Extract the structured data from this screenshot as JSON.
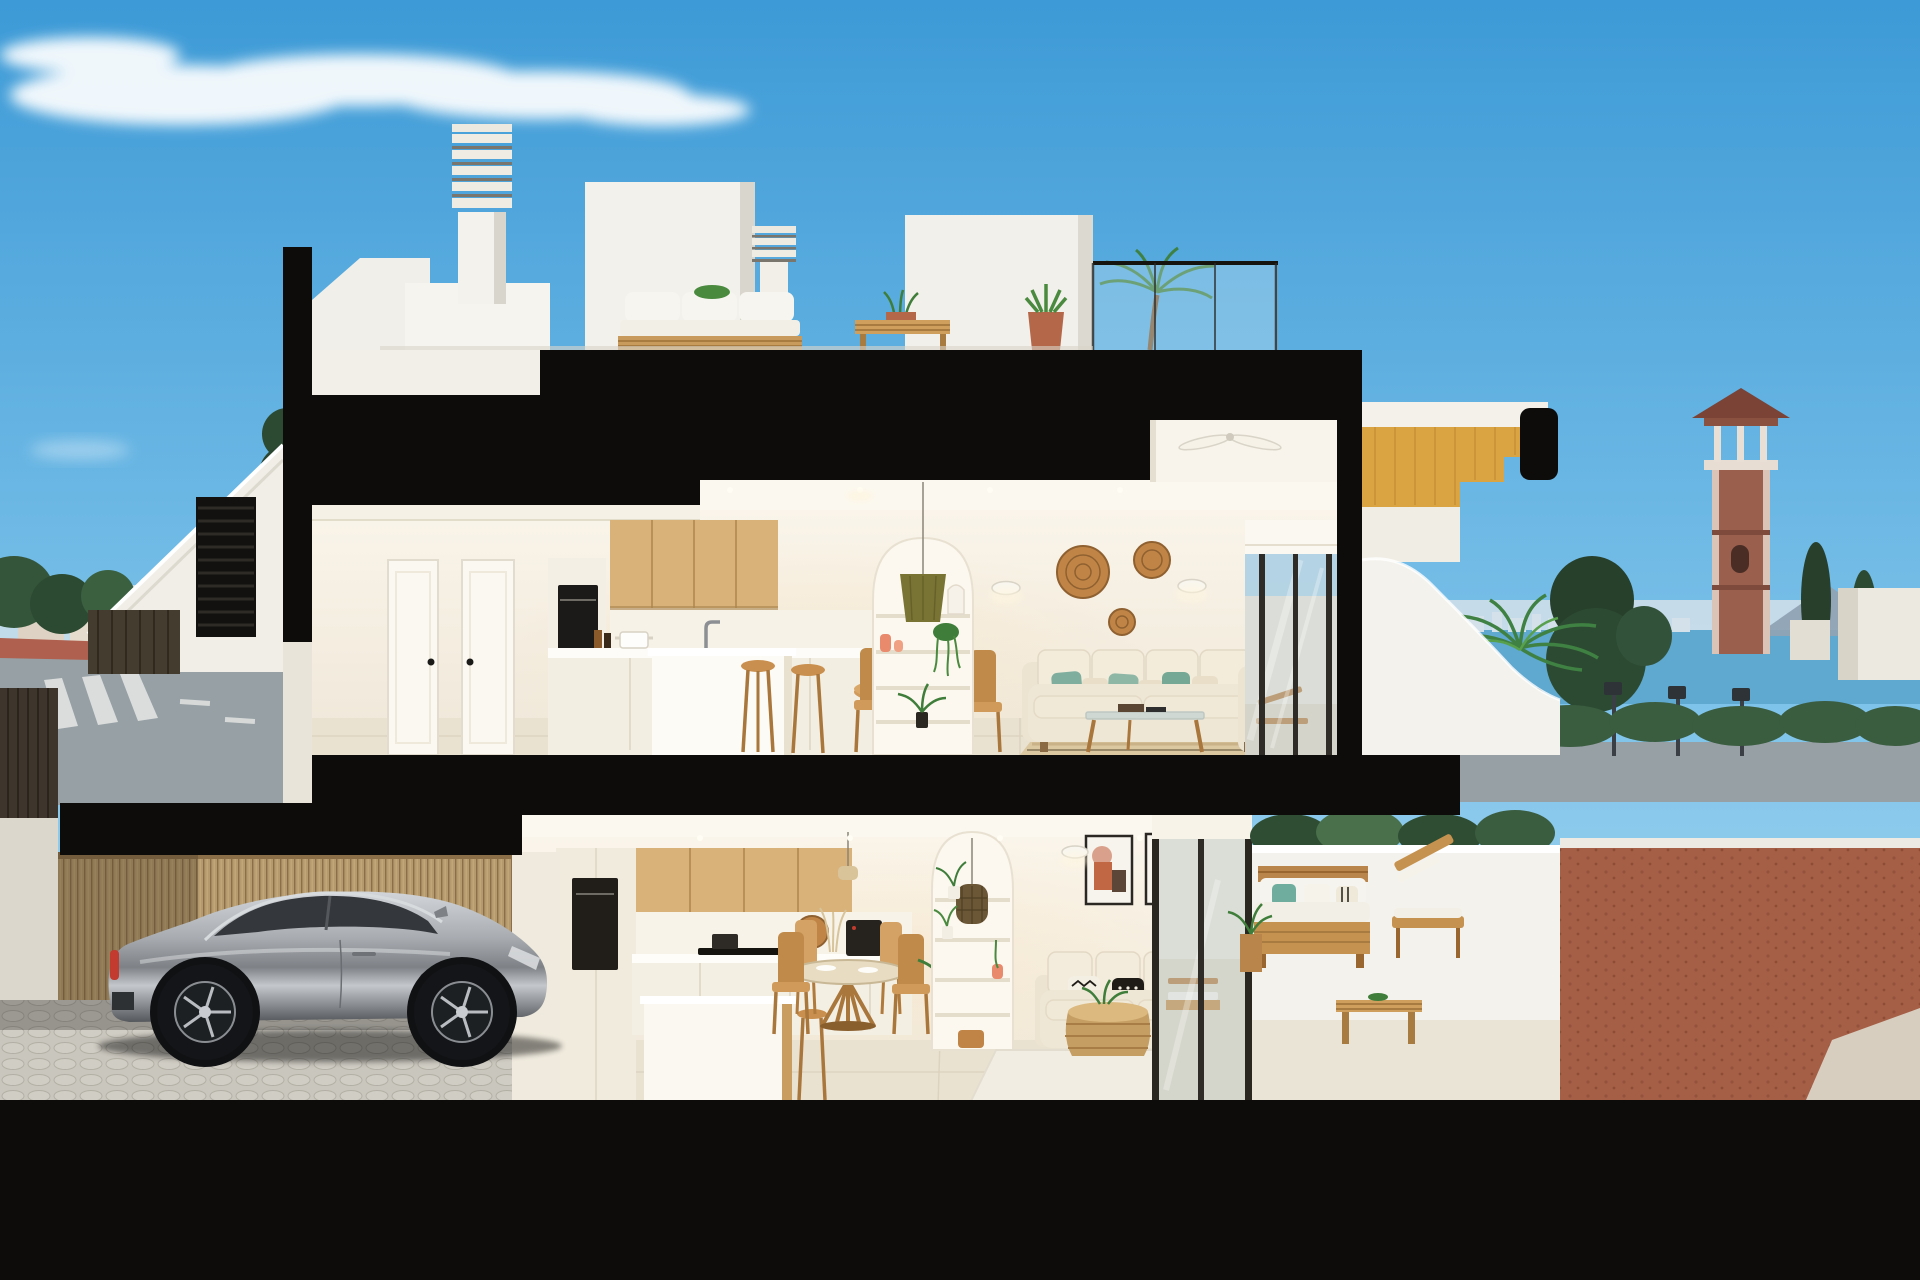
{
  "palette": {
    "sky_top": "#3D9AD6",
    "sky_mid": "#7EC3EA",
    "sky_horizon": "#BCE1F2",
    "cloud": "#FFFFFF",
    "cut_black": "#0D0C0A",
    "ground_black": "#0A0A09",
    "wall_white": "#F3F1EA",
    "wall_shade": "#DCD8CD",
    "interior_wall": "#FAF4E8",
    "interior_floor": "#EAE2D1",
    "ceiling": "#FBF8F0",
    "wood_cabinet": "#D8B279",
    "wood_furniture": "#C6924F",
    "wood_stair_soffit": "#D9A441",
    "bamboo_fence": "#B59A6D",
    "rattan": "#C08546",
    "jute_rug": "#DCC8A0",
    "sofa_cream": "#EFE7D6",
    "pillow_teal": "#7FAE9E",
    "pillow_black": "#1F1C18",
    "olive_lampshade": "#7A7434",
    "coral_vase": "#E98A6D",
    "art_terracotta": "#C26744",
    "art_blush": "#D9A08B",
    "art_brown": "#5C4638",
    "plant_green": "#3F7D3A",
    "plant_light": "#58A04B",
    "tree_dark": "#2C4A31",
    "hedge": "#3A5C3F",
    "car_silver": "#9DA1A6",
    "car_glass": "#34373B",
    "tail_light_red": "#C23B2E",
    "cobble_floor": "#C9C6BD",
    "sea": "#5FA8CF",
    "skyline_haze": "#D4E1EA",
    "mountain": "#8FA3B5",
    "tower_brick": "#9A5F4D",
    "tower_roof": "#7A4336",
    "road": "#96A0A5",
    "sidewalk_red": "#AF604E",
    "sign_blue": "#2F6FC0",
    "gravel_rust": "#A55F46",
    "glass_tint": "#C3D2D4",
    "frame_dark": "#2A2620"
  },
  "scene": {
    "subject": "cutaway-cross-section-render-of-two-storey-townhouse",
    "time_of_day": "day",
    "cloud_count": 3
  },
  "background_left": {
    "items": [
      "pine-trees",
      "distant-town-buildings",
      "apartment-block",
      "road",
      "red-sidewalk",
      "crosswalk",
      "blue-traffic-sign"
    ]
  },
  "background_right": {
    "items": [
      "sea-horizon",
      "distant-skyline",
      "mountains",
      "brick-watchtower",
      "cypress-trees",
      "street-lamps",
      "hedge",
      "white-houses",
      "gravel-yard"
    ]
  },
  "roof_level": {
    "items": [
      "louvered-chimney-tall",
      "louvered-chimney-short",
      "stair-bulkhead",
      "outdoor-sofa",
      "slat-coffee-table",
      "potted-aloe",
      "potted-palm",
      "glass-balustrade",
      "timber-roof-stair"
    ]
  },
  "upper_floor": {
    "rooms": [
      {
        "name": "entry-hall",
        "items": [
          "interior-door",
          "interior-door"
        ]
      },
      {
        "name": "kitchen",
        "items": [
          "oven-column",
          "oak-wall-cabinets",
          "island-counter",
          "faucet",
          "cook-pot",
          "bar-stool",
          "bar-stool"
        ]
      },
      {
        "name": "dining",
        "items": [
          "round-oak-table",
          "dining-chair",
          "dining-chair",
          "dining-chair",
          "dining-chair",
          "table-plant"
        ]
      },
      {
        "name": "living",
        "items": [
          "arched-shelf-niche",
          "olive-pendant-lamp",
          "coral-vases",
          "trailing-plant",
          "wall-sconce",
          "wall-sconce",
          "rattan-wall-discs",
          "cream-sofa",
          "teal-cushions",
          "glass-coffee-table",
          "jute-rug",
          "ceiling-fan",
          "sliding-glass-door"
        ]
      },
      {
        "name": "terrace",
        "items": [
          "curved-parapet",
          "wooden-sun-lounger",
          "side-table",
          "potted-palm"
        ]
      }
    ]
  },
  "lower_floor": {
    "rooms": [
      {
        "name": "garage",
        "items": [
          "bamboo-slat-wall",
          "silver-sports-car",
          "cobblestone-floor"
        ]
      },
      {
        "name": "kitchen",
        "items": [
          "oven-column",
          "oak-wall-cabinets",
          "induction-hob",
          "coffee-machine",
          "island-counter",
          "wooden-stool",
          "rattan-decor"
        ]
      },
      {
        "name": "dining",
        "items": [
          "round-table",
          "dining-chair",
          "dining-chair",
          "dining-chair",
          "dining-chair",
          "mini-pendant"
        ]
      },
      {
        "name": "living",
        "items": [
          "arched-shelf-niche",
          "woven-pendant-lamp",
          "framed-abstract-art",
          "framed-abstract-art",
          "wall-sconce",
          "wall-sconce",
          "cream-sofa",
          "patterned-cushions",
          "rattan-drum-table",
          "white-rug",
          "plant-stand",
          "sliding-glass-door"
        ]
      },
      {
        "name": "patio",
        "items": [
          "white-parapet",
          "timber-outdoor-sofa",
          "timber-lounge-chair",
          "slat-coffee-table",
          "white-cushions",
          "teal-cushion"
        ]
      }
    ]
  },
  "structure": {
    "cut_elements": [
      "left-wall-cut",
      "roof-slab-cut",
      "mid-slab-cut",
      "garage-slab-cut",
      "right-wall-cut",
      "stair-stringer-cut",
      "ground-cut"
    ]
  }
}
